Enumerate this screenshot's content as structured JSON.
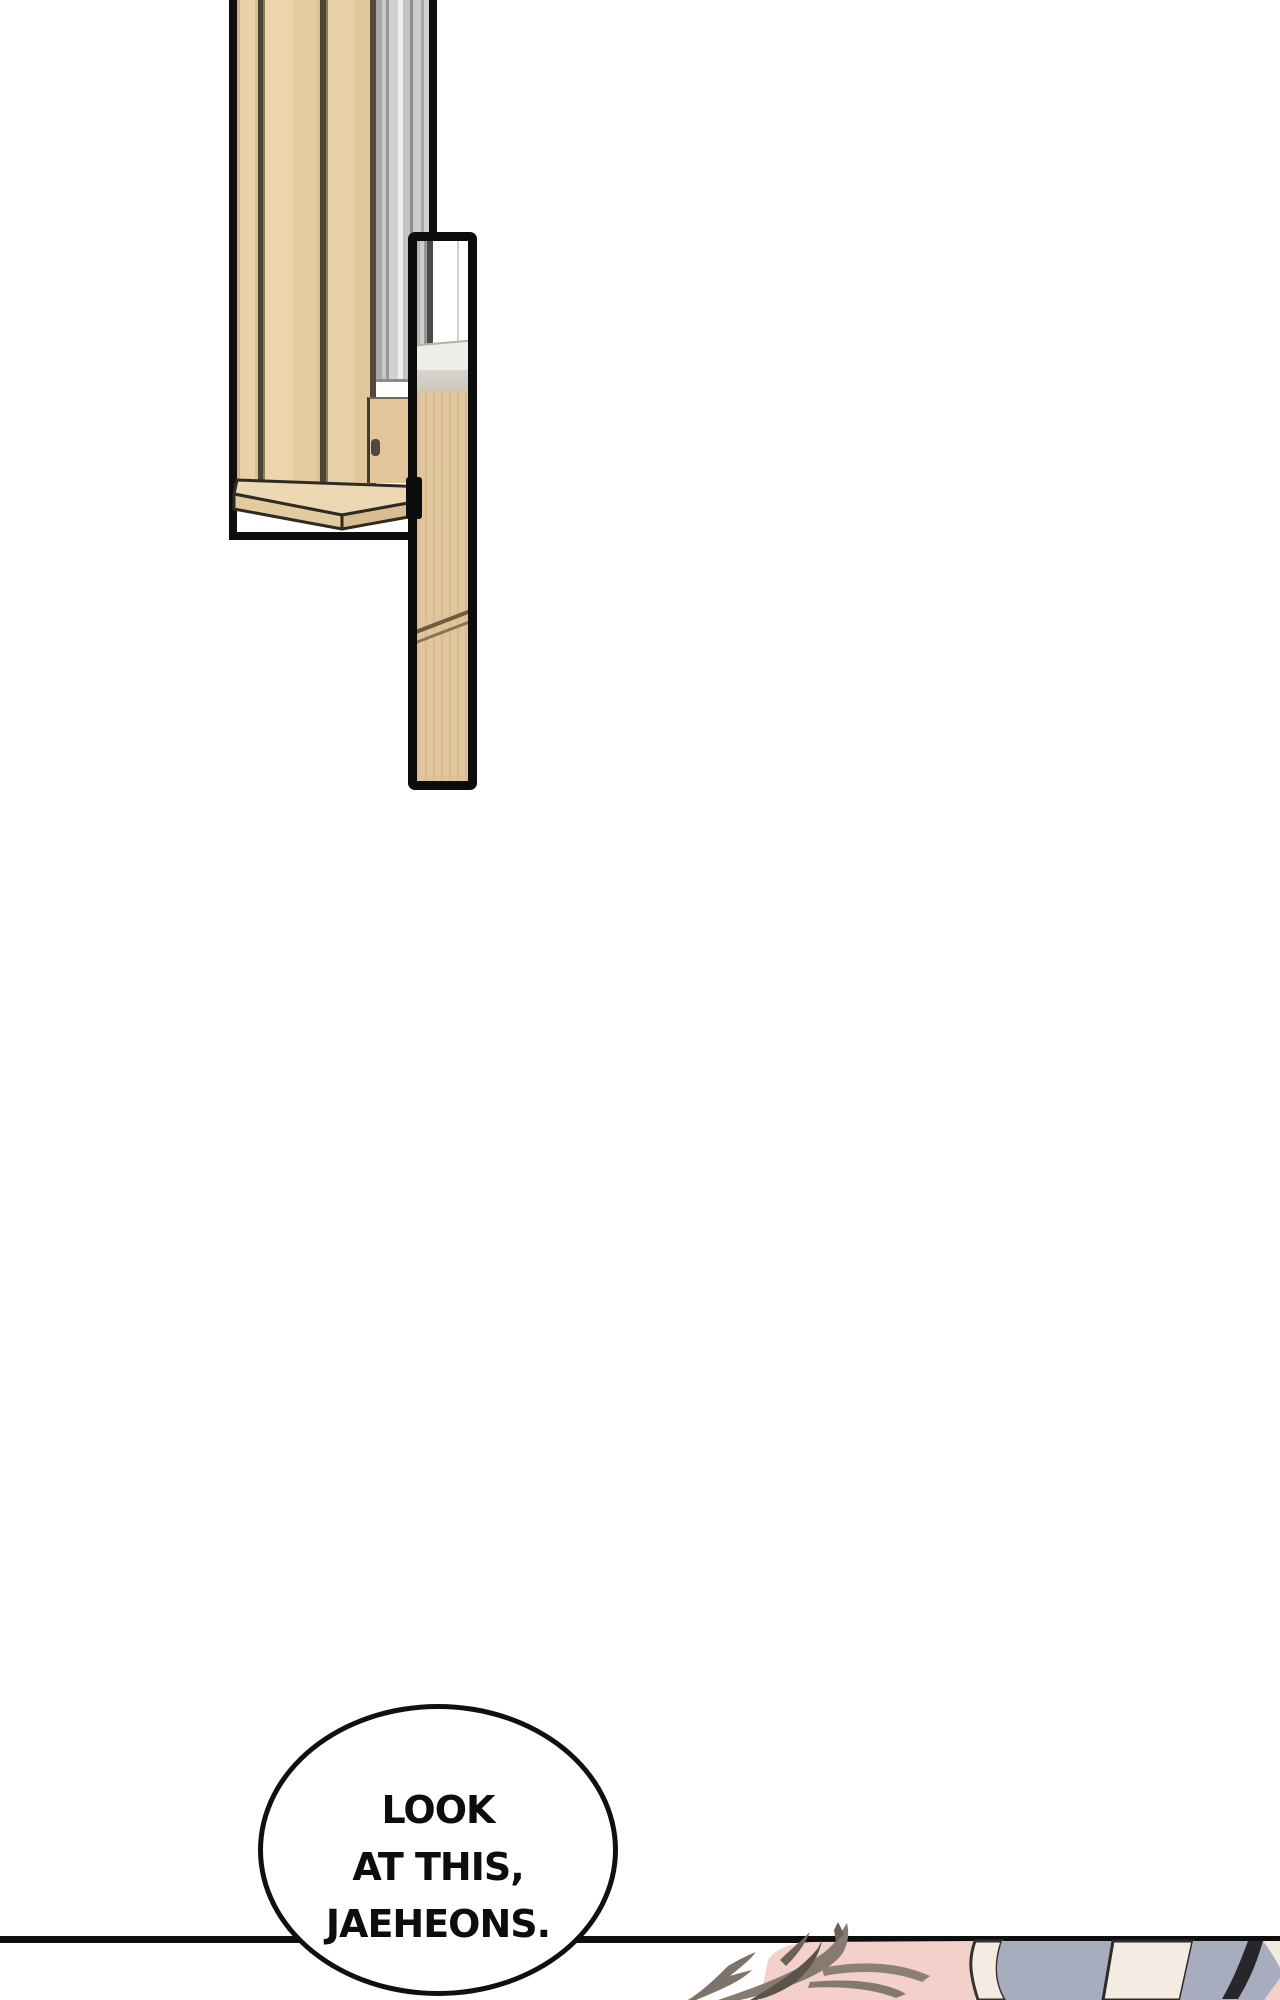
{
  "comic": {
    "speech_bubble": {
      "lines": [
        "LOOK",
        "AT THIS,",
        "JAEHEONS."
      ]
    },
    "panels": [
      {
        "id": "tall-furniture-panel",
        "content": "wooden slat bench with gray slatted wall, partial view cut at top"
      },
      {
        "id": "narrow-strip-panel",
        "content": "close-up strip of the wooden bench leg with diagonal seam"
      },
      {
        "id": "bottom-scene-panel",
        "content": "cropped close-up of a character's head: spiky hair, skin, blue-gray cloth, dark lock"
      }
    ],
    "colors": {
      "ink": "#0e0e0e",
      "wood_slat_light": "#ecd5ad",
      "wood_bench": "#e2c69a",
      "wood_plank_top": "#ecd9b3",
      "wood_strip": "#e1c69d",
      "gray_wall": "#c9c8c6",
      "hair": "#857b71",
      "skin_pink": "#f3d0ca",
      "cloth_blue_gray": "#a7adbf",
      "cream": "#f4ebe3",
      "dark_lock": "#26262b"
    }
  }
}
